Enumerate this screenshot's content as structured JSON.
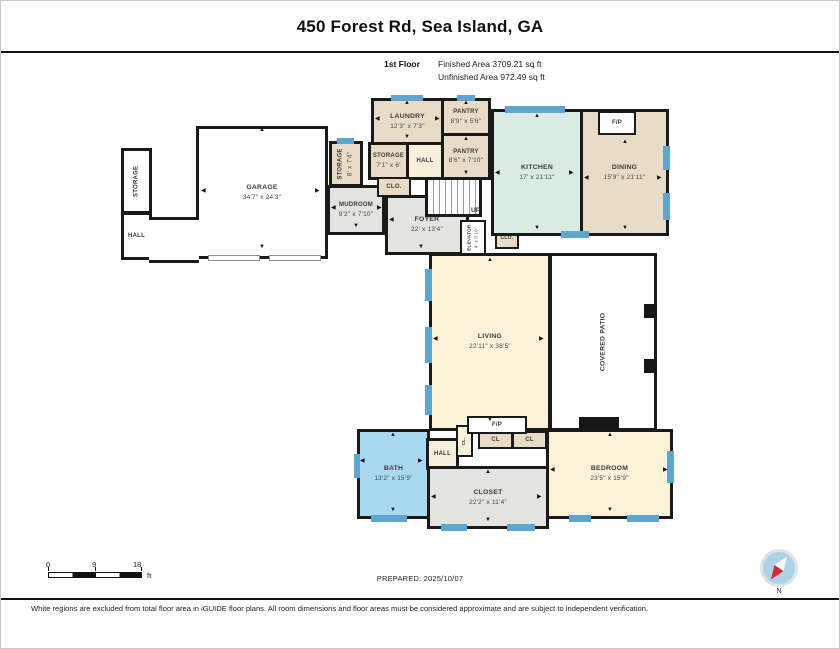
{
  "header": {
    "title": "450 Forest Rd, Sea Island, GA",
    "floor_label": "1st Floor",
    "finished_area": "Finished Area 3709.21 sq ft",
    "unfinished_area": "Unfinished Area 972.49 sq ft"
  },
  "rooms": {
    "garage": {
      "name": "GARAGE",
      "dims": "34'7\" x 24'3\""
    },
    "storage_left": {
      "name": "STORAGE"
    },
    "hall_left": {
      "name": "HALL"
    },
    "storage_side": {
      "name": "STORAGE",
      "dims": "8' x 7'4\""
    },
    "mudroom": {
      "name": "MUDROOM",
      "dims": "9'2\" x 7'10\""
    },
    "laundry": {
      "name": "LAUNDRY",
      "dims": "12'3\" x 7'3\""
    },
    "pantry_upper": {
      "name": "PANTRY",
      "dims": "8'9\" x 5'6\""
    },
    "storage_inner": {
      "name": "STORAGE",
      "dims": "7'1\" x 6'"
    },
    "hall_upper": {
      "name": "HALL"
    },
    "pantry_lower": {
      "name": "PANTRY",
      "dims": "8'6\" x 7'10\""
    },
    "closet_upper": {
      "name": "CLO."
    },
    "stairs": {
      "name": "UP"
    },
    "foyer": {
      "name": "FOYER",
      "dims": "22' x 13'4\""
    },
    "elevator": {
      "name": "ELEVATOR",
      "dims": "4' x 5'10\""
    },
    "closet_mid": {
      "name": "CLO."
    },
    "kitchen": {
      "name": "KITCHEN",
      "dims": "17' x 21'11\""
    },
    "dining": {
      "name": "DINING",
      "dims": "15'9\" x 21'11\""
    },
    "fireplace_dining": {
      "name": "F/P"
    },
    "living": {
      "name": "LIVING",
      "dims": "22'11\" x 38'5\""
    },
    "covered_patio": {
      "name": "COVERED PATIO"
    },
    "fireplace_living": {
      "name": "F/P"
    },
    "hall_lower": {
      "name": "HALL"
    },
    "closet_tiny": {
      "name": "CL."
    },
    "cl_left": {
      "name": "CL"
    },
    "cl_right": {
      "name": "CL"
    },
    "bath": {
      "name": "BATH",
      "dims": "13'2\" x 15'9\""
    },
    "closet_main": {
      "name": "CLOSET",
      "dims": "22'2\" x 11'4\""
    },
    "bedroom": {
      "name": "BEDROOM",
      "dims": "23'5\" x 15'9\""
    }
  },
  "footer": {
    "scale_ticks": [
      "0",
      "9",
      "18"
    ],
    "scale_unit": "ft",
    "prepared": "PREPARED: 2025/10/07",
    "disclaimer": "White regions are excluded from total floor area in iGUIDE floor plans. All room dimensions and floor areas must be considered approximate and are subject to independent verification.",
    "compass_label": "N"
  },
  "colors": {
    "wall": "#1a1a1a",
    "window": "#5fa6cf",
    "tan": "#e8dcc6",
    "cream": "#faf3da",
    "mint": "#d9ebe2",
    "gray": "#e3e3e0",
    "bath_blue": "#a9d8f1",
    "compass_red": "#d22b2b"
  }
}
